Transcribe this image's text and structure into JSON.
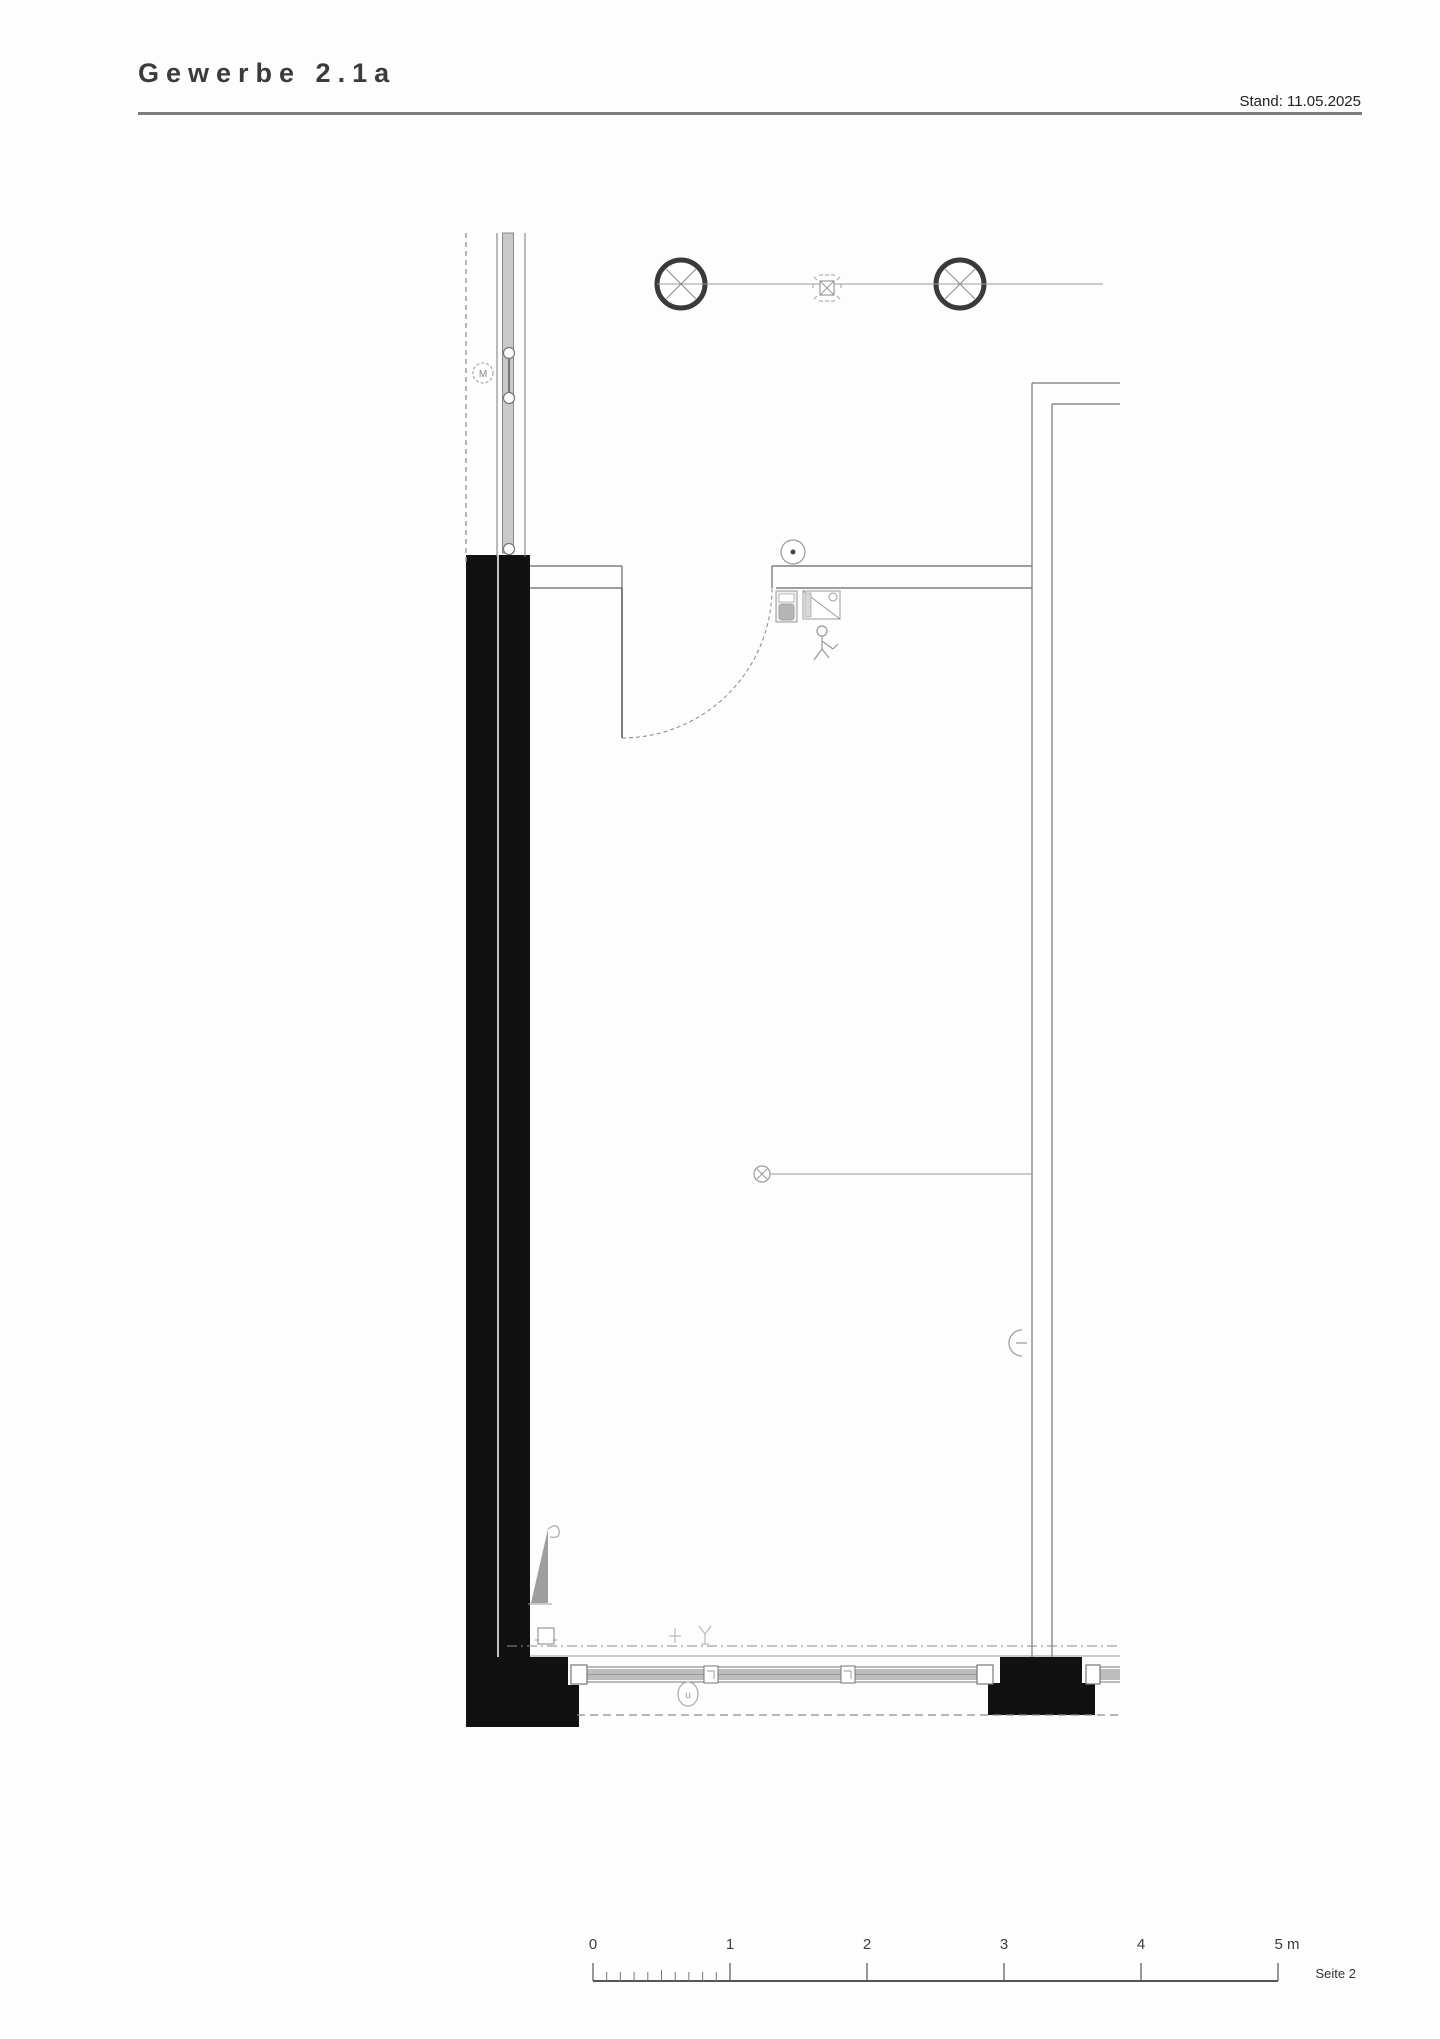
{
  "header": {
    "title": "Gewerbe 2.1a",
    "stand": "Stand: 11.05.2025"
  },
  "plan": {
    "window_marker": "M",
    "door_marker": "u"
  },
  "scale_bar": {
    "labels": [
      "0",
      "1",
      "2",
      "3",
      "4",
      "5 m"
    ]
  },
  "footer": {
    "page": "Seite 2"
  },
  "colors": {
    "wall_poche": "#111111",
    "thin_line": "#8a8a8a",
    "dark_line": "#3a3a3a",
    "glazing_fill": "#bdbdbd",
    "triangle_fill": "#9e9e9e",
    "paper": "#fdfdfd"
  }
}
